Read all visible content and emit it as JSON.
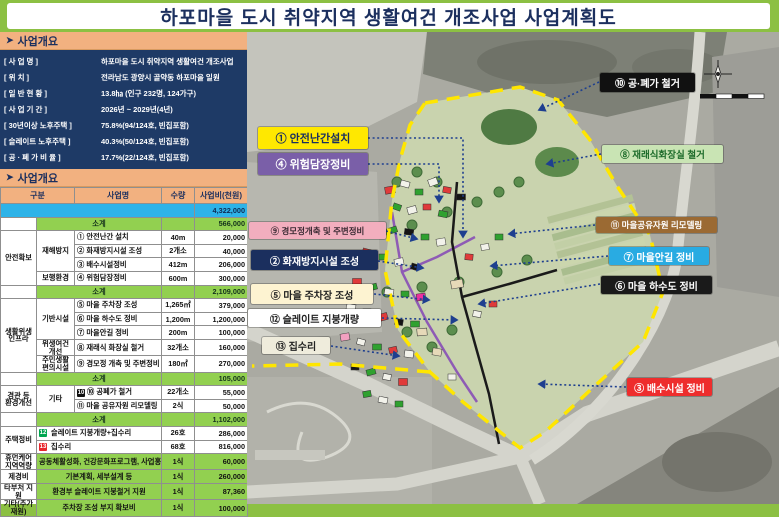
{
  "title": "하포마을 도시 취약지역 생활여건 개조사업 사업계획도",
  "colors": {
    "frame_green": "#8cc043",
    "title_navy": "#1b2f5e",
    "section_header_orange": "#f2b180",
    "info_navy": "#1e3a66",
    "total_blue": "#2eb3e8",
    "subtotal_green": "#92d050",
    "boundary_yellow": "#ffe600",
    "leader_blue": "#1e3f8f"
  },
  "overview": {
    "header": "사업개요",
    "rows": [
      {
        "label": "[ 사      업      명 ]",
        "value": "하포마을 도시 취약지역 생활여건 개조사업"
      },
      {
        "label": "[ 위                치 ]",
        "value": "전라남도 광양시 골약동 하포마을 일원"
      },
      {
        "label": "[ 일   반   현   황 ]",
        "value": "13.8㏊ (인구 232명, 124가구)"
      },
      {
        "label": "[ 사   업   기   간 ]",
        "value": "2026년 ~ 2029년(4년)"
      },
      {
        "label": "[ 30년이상 노후주택 ]",
        "value": "75.8%(94/124호, 빈집포함)"
      },
      {
        "label": "[ 슬레이트  노후주택 ]",
        "value": "40.3%(50/124호, 빈집포함)"
      },
      {
        "label": "[ 공 · 폐 가   비 율 ]",
        "value": "17.7%(22/124호, 빈집포함)"
      }
    ]
  },
  "budget": {
    "header": "사업개요",
    "columns": [
      "구분",
      "사업명",
      "수량",
      "사업비(천원)"
    ],
    "rows": [
      {
        "kind": "total",
        "amount": "4,322,000"
      },
      {
        "kind": "subtotal",
        "label": "소계",
        "amount": "566,000"
      },
      {
        "kind": "item",
        "g1": {
          "text": "안전확보",
          "span": 4
        },
        "g2": {
          "text": "재해방지",
          "span": 3
        },
        "num": "①",
        "name": "안전난간 설치",
        "qty": "40m",
        "amount": "20,000"
      },
      {
        "kind": "item",
        "num": "②",
        "name": "화재방지시설 조성",
        "qty": "2개소",
        "amount": "40,000"
      },
      {
        "kind": "item",
        "num": "③",
        "name": "배수시설정비",
        "qty": "412m",
        "amount": "206,000"
      },
      {
        "kind": "item",
        "g2": {
          "text": "보행환경",
          "span": 1
        },
        "num": "④",
        "name": "위험담장정비",
        "qty": "600m",
        "amount": "300,000"
      },
      {
        "kind": "subtotal",
        "label": "소계",
        "amount": "2,109,000"
      },
      {
        "kind": "item",
        "g1": {
          "text": "생활위생\n인프라",
          "span": 5
        },
        "g2": {
          "text": "기반시설",
          "span": 3
        },
        "num": "⑤",
        "name": "마을 주차장 조성",
        "qty": "1,265㎡",
        "amount": "379,000"
      },
      {
        "kind": "item",
        "num": "⑥",
        "name": "마을 하수도 정비",
        "qty": "1,200m",
        "amount": "1,200,000"
      },
      {
        "kind": "item",
        "num": "⑦",
        "name": "마을안길 정비",
        "qty": "200m",
        "amount": "100,000"
      },
      {
        "kind": "item",
        "g2": {
          "text": "위생여건개선",
          "span": 1
        },
        "num": "⑧",
        "name": "재래식 화장실 철거",
        "qty": "32개소",
        "amount": "160,000"
      },
      {
        "kind": "item",
        "g2": {
          "text": "주민생활\n편의시설",
          "span": 1
        },
        "num": "⑨",
        "name": "경모정 개축 및 주변정비",
        "qty": "180㎡",
        "amount": "270,000"
      },
      {
        "kind": "subtotal",
        "label": "소계",
        "amount": "105,000"
      },
      {
        "kind": "item",
        "g1": {
          "text": "경관 등\n환경개선",
          "span": 2
        },
        "g2": {
          "text": "기타",
          "span": 2
        },
        "num": "⑩",
        "chip": "black",
        "chipnum": "10",
        "name": "공폐가 철거",
        "qty": "22개소",
        "amount": "55,000"
      },
      {
        "kind": "item",
        "num": "⑪",
        "name": "마을 공유자원 리모델링",
        "qty": "2식",
        "amount": "50,000"
      },
      {
        "kind": "subtotal",
        "label": "소계",
        "amount": "1,102,000"
      },
      {
        "kind": "item2",
        "g1": {
          "text": "주택정비",
          "span": 2
        },
        "chip": "green",
        "chipnum": "12",
        "name": "슬레이트 지붕개량+집수리",
        "qty": "26호",
        "amount": "286,000"
      },
      {
        "kind": "item2",
        "chip": "red",
        "chipnum": "13",
        "name": "집수리",
        "qty": "68호",
        "amount": "816,000"
      },
      {
        "kind": "greenrow",
        "g1": "휴먼케어\n지역역량",
        "name": "공동체활성화, 건강문화프로그램, 사업홍보 등",
        "qty": "1식",
        "amount": "60,000"
      },
      {
        "kind": "greenrow",
        "g1": "제경비",
        "name": "기본계획, 세부설계 등",
        "qty": "1식",
        "amount": "260,000"
      },
      {
        "kind": "greenrow",
        "g1": "타부처 지원",
        "name": "환경부 슬레이트 지붕철거 지원",
        "qty": "1식",
        "amount": "87,360"
      },
      {
        "kind": "greenrow",
        "g1": "기타(추가재원)",
        "name": "주차장 조성 부지 확보비",
        "qty": "1식",
        "amount": "100,000"
      }
    ]
  },
  "map": {
    "callouts": [
      {
        "num": "①",
        "label": "안전난간설치",
        "bg": "#ffe800",
        "fg": "#1b2f5e"
      },
      {
        "num": "④",
        "label": "위험담장정비",
        "bg": "#7a5fa8",
        "fg": "#ffffff"
      },
      {
        "num": "⑨",
        "label": "경모정개축 및 주변정비",
        "bg": "#f2aebe",
        "fg": "#3a2a33"
      },
      {
        "num": "②",
        "label": "화재방지시설 조성",
        "bg": "#1b2f5e",
        "fg": "#ffffff"
      },
      {
        "num": "⑤",
        "label": "마을 주차장 조성",
        "bg": "#fdf3d1",
        "fg": "#222222"
      },
      {
        "num": "⑫",
        "label": "슬레이트 지붕개량",
        "bg": "#ffffff",
        "fg": "#222222"
      },
      {
        "num": "⑬",
        "label": "집수리",
        "bg": "#efecdc",
        "fg": "#222222"
      },
      {
        "num": "⑩",
        "label": "공·폐가 철거",
        "bg": "#111111",
        "fg": "#ffffff"
      },
      {
        "num": "⑧",
        "label": "재래식화장실 철거",
        "bg": "#c9e4b4",
        "fg": "#1d6b2a"
      },
      {
        "num": "⑪",
        "label": "마을공유자원 리모델링",
        "bg": "#9b6a33",
        "fg": "#ffffff"
      },
      {
        "num": "⑦",
        "label": "마을안길 정비",
        "bg": "#29abe2",
        "fg": "#ffffff"
      },
      {
        "num": "⑥",
        "label": "마을 하수도 정비",
        "bg": "#1a1a1a",
        "fg": "#ffffff"
      },
      {
        "num": "③",
        "label": "배수시설 정비",
        "bg": "#ee2d2d",
        "fg": "#ffffff"
      }
    ],
    "building_palette": {
      "r": "#e03a3a",
      "g": "#2fa12f",
      "w": "#f2f2ea",
      "k": "#141414",
      "m": "#ec2f9e",
      "p": "#f2a0c0",
      "t": "#e6d9b8"
    }
  }
}
